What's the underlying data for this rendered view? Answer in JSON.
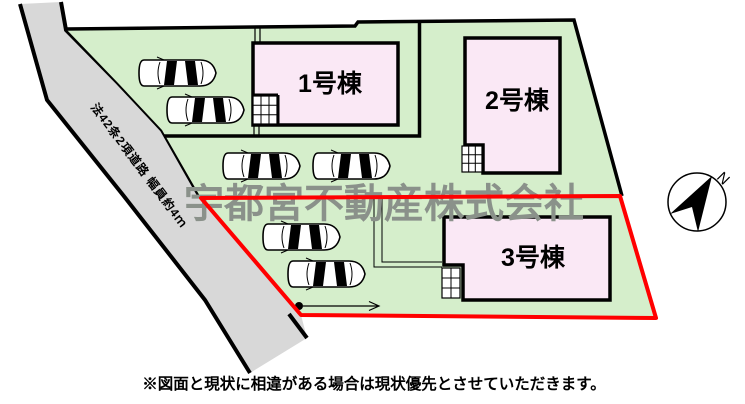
{
  "plan": {
    "road_label": "法42条2項道路 幅員約4ｍ",
    "buildings": [
      {
        "label": "1号棟"
      },
      {
        "label": "2号棟"
      },
      {
        "label": "3号棟"
      }
    ],
    "watermark": "宇都宮不動産株式会社",
    "compass": {
      "label": "N"
    },
    "note": "※図面と現状に相違がある場合は現状優先とさせていただきます。",
    "colors": {
      "site_green": "#d5eecb",
      "road_gray": "#d8d8d8",
      "building_pink": "#fae8f5",
      "boundary_red": "#ff0000",
      "line_black": "#000000",
      "watermark_gray": "#8a918a"
    }
  }
}
